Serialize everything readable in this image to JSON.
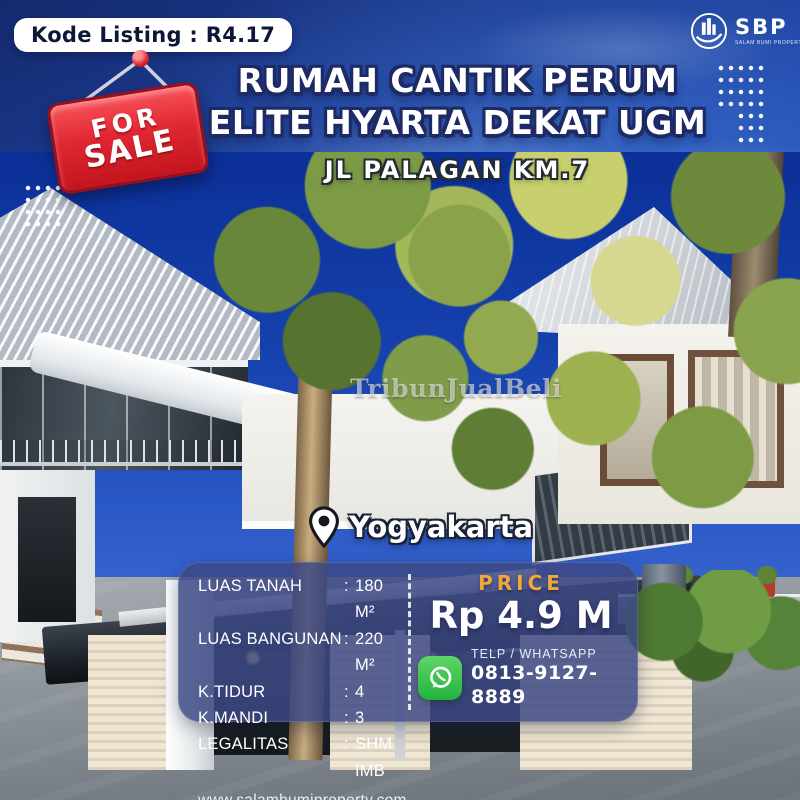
{
  "badge": {
    "kode_listing": "Kode Listing : R4.17"
  },
  "logo": {
    "name": "SBP",
    "subtext": "SALAM BUMI PROPERTY"
  },
  "sale_sign": {
    "line1": "FOR",
    "line2": "SALE"
  },
  "title": {
    "line1": "RUMAH CANTIK PERUM",
    "line2": "ELITE HYARTA DEKAT UGM",
    "subtitle": "JL PALAGAN KM.7"
  },
  "watermark": "TribunJualBeli",
  "location": {
    "city": "Yogyakarta"
  },
  "details": {
    "separator": ":",
    "rows": [
      {
        "label": "LUAS TANAH",
        "value": "180 M²"
      },
      {
        "label": "LUAS BANGUNAN",
        "value": "220 M²"
      },
      {
        "label": "K.TIDUR",
        "value": "4"
      },
      {
        "label": "K.MANDI",
        "value": "3"
      },
      {
        "label": "LEGALITAS",
        "value": "SHM IMB"
      }
    ],
    "website": "www.salambumiproperty.com"
  },
  "price": {
    "label": "PRICE",
    "value": "Rp 4.9 M"
  },
  "contact": {
    "method": "TELP / WHATSAPP",
    "number": "0813-9127-8889"
  },
  "icons": {
    "location": "map-pin-icon",
    "whatsapp": "whatsapp-icon",
    "logo_emblem": "sbp-building-emblem-icon",
    "sale_pin": "red-pushpin-icon"
  },
  "colors": {
    "background_blue": "#1d3f9b",
    "panel_blue": "rgba(60,72,132,0.84)",
    "price_label_orange": "#f2a73b",
    "sale_sign_red": "#d61f2c",
    "whatsapp_green": "#21b23c"
  }
}
